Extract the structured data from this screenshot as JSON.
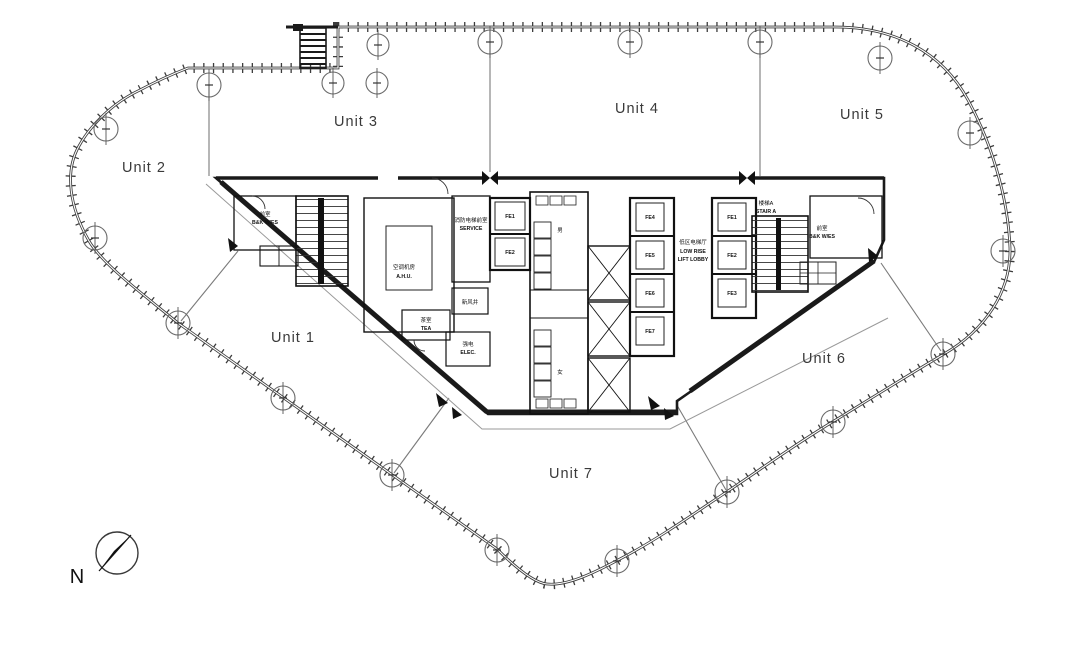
{
  "units": {
    "unit1": "Unit 1",
    "unit2": "Unit 2",
    "unit3": "Unit 3",
    "unit4": "Unit 4",
    "unit5": "Unit 5",
    "unit6": "Unit 6",
    "unit7": "Unit 7"
  },
  "compass": {
    "north": "N"
  },
  "core": {
    "stair_a": {
      "zh": "楼梯A",
      "en": "STAIR A"
    },
    "left_lobby": {
      "zh": "前室",
      "en": "B&K W/ES"
    },
    "right_lobby": {
      "zh": "前室",
      "en": "B&K W/ES"
    },
    "service": {
      "zh": "消防电梯前室",
      "en": "SERVICE"
    },
    "ahu": {
      "zh": "空调机房",
      "en": "A.H.U."
    },
    "fresh_air": {
      "zh": "新风井"
    },
    "tea": {
      "zh": "茶室",
      "en": "TEA"
    },
    "elec": {
      "zh": "强电",
      "en": "ELEC."
    },
    "low_rise_lobby": {
      "zh": "低区电梯厅",
      "en1": "LOW RISE",
      "en2": "LIFT LOBBY"
    },
    "toilets": {
      "male": "男",
      "female": "女"
    },
    "service_lifts": [
      {
        "id": "FE1"
      },
      {
        "id": "FE2"
      }
    ],
    "mid_lifts": [
      {
        "id": "FE4"
      },
      {
        "id": "FE5"
      },
      {
        "id": "FE6"
      },
      {
        "id": "FE7"
      }
    ],
    "right_lifts": [
      {
        "id": "FE1"
      },
      {
        "id": "FE2"
      },
      {
        "id": "FE3"
      }
    ]
  },
  "colors": {
    "ink": "#1a1a1a",
    "line_gray": "#777777",
    "paper": "#ffffff"
  }
}
